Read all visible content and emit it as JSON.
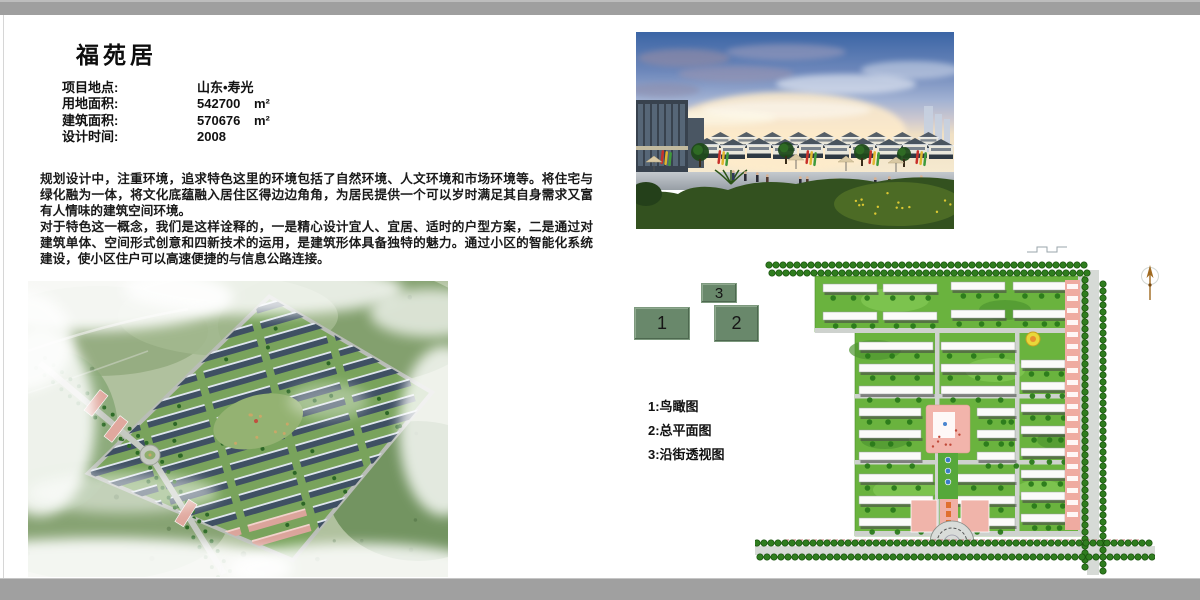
{
  "title": "福苑居",
  "info": {
    "rows": [
      {
        "label": "项目地点:",
        "value": "山东•寿光",
        "unit": ""
      },
      {
        "label": "用地面积:",
        "value": "542700",
        "unit": "m²"
      },
      {
        "label": "建筑面积:",
        "value": "570676",
        "unit": "m²"
      },
      {
        "label": "设计时间:",
        "value": "2008",
        "unit": ""
      }
    ]
  },
  "paragraphs": [
    "规划设计中，注重环境，追求特色这里的环境包括了自然环境、人文环境和市场环境等。将住宅与绿化融为一体，将文化底蕴融入居住区得边边角角，为居民提供一个可以岁时满足其自身需求又富有人情味的建筑空间环境。",
    "对于特色这一概念，我们是这样诠释的，一是精心设计宜人、宜居、适时的户型方案，二是通过对建筑单体、空间形式创意和四新技术的运用，是建筑形体具备独特的魅力。通过小区的智能化系统建设，使小区住户可以高速便捷的与信息公路连接。"
  ],
  "legend": {
    "nums": [
      "1",
      "2",
      "3"
    ],
    "items": [
      "1:鸟瞰图",
      "2:总平面图",
      "3:沿街透视图"
    ],
    "marker_color": "#69886b"
  },
  "colors": {
    "frame_gray": "#9f9f9f",
    "legend_green": "#69886b",
    "site_green": "#6ab33e",
    "plaza_pink": "#f2b4ab",
    "sky_blue": "#3b65a5"
  }
}
